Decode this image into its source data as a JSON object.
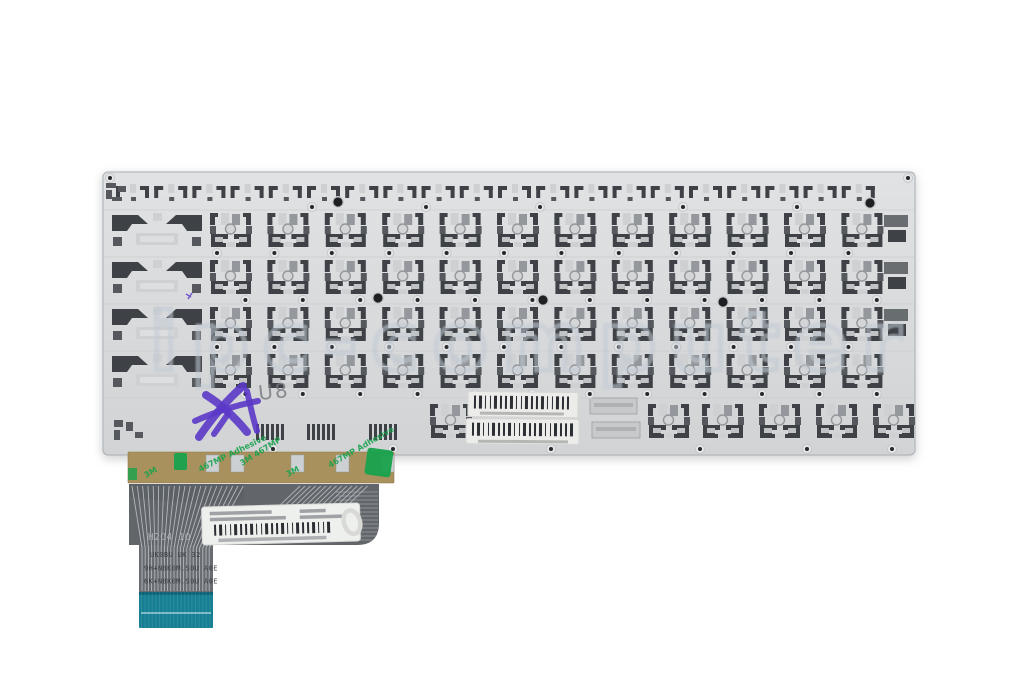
{
  "watermark": {
    "text": "ipc-computer",
    "stroke_color": "#c6cdd5"
  },
  "plate": {
    "color": "#d8dadc",
    "edge_color": "#aab0b4",
    "cutout_dark": "#3e4246",
    "cutout_mid": "#55595d",
    "cutout_light": "#ced0d2",
    "key_rows": 4,
    "keys_per_row": 12,
    "function_row_hooks": 20,
    "bottom_right_keys": 4,
    "barcode_labels_on_plate": 2
  },
  "markings": {
    "pencil_text": "U8",
    "pencil_color": "#75787c",
    "ink_color": "#5b38c8"
  },
  "flex_cable": {
    "base_color": "#62666b",
    "trace_color": "#c3c7ca",
    "connector_color": "#177f93",
    "print_lines": [
      "H2O4 1O",
      "UK0BU UK 32",
      "9H+N8K0M.S0U A0E",
      "6K+N8K0M.S0U A0E"
    ]
  },
  "adhesive_tape": {
    "color": "#a8915c",
    "print_color": "#17a24c",
    "print_fragments": [
      "3M",
      "467MP Adhesive",
      "3M 467MP"
    ]
  }
}
